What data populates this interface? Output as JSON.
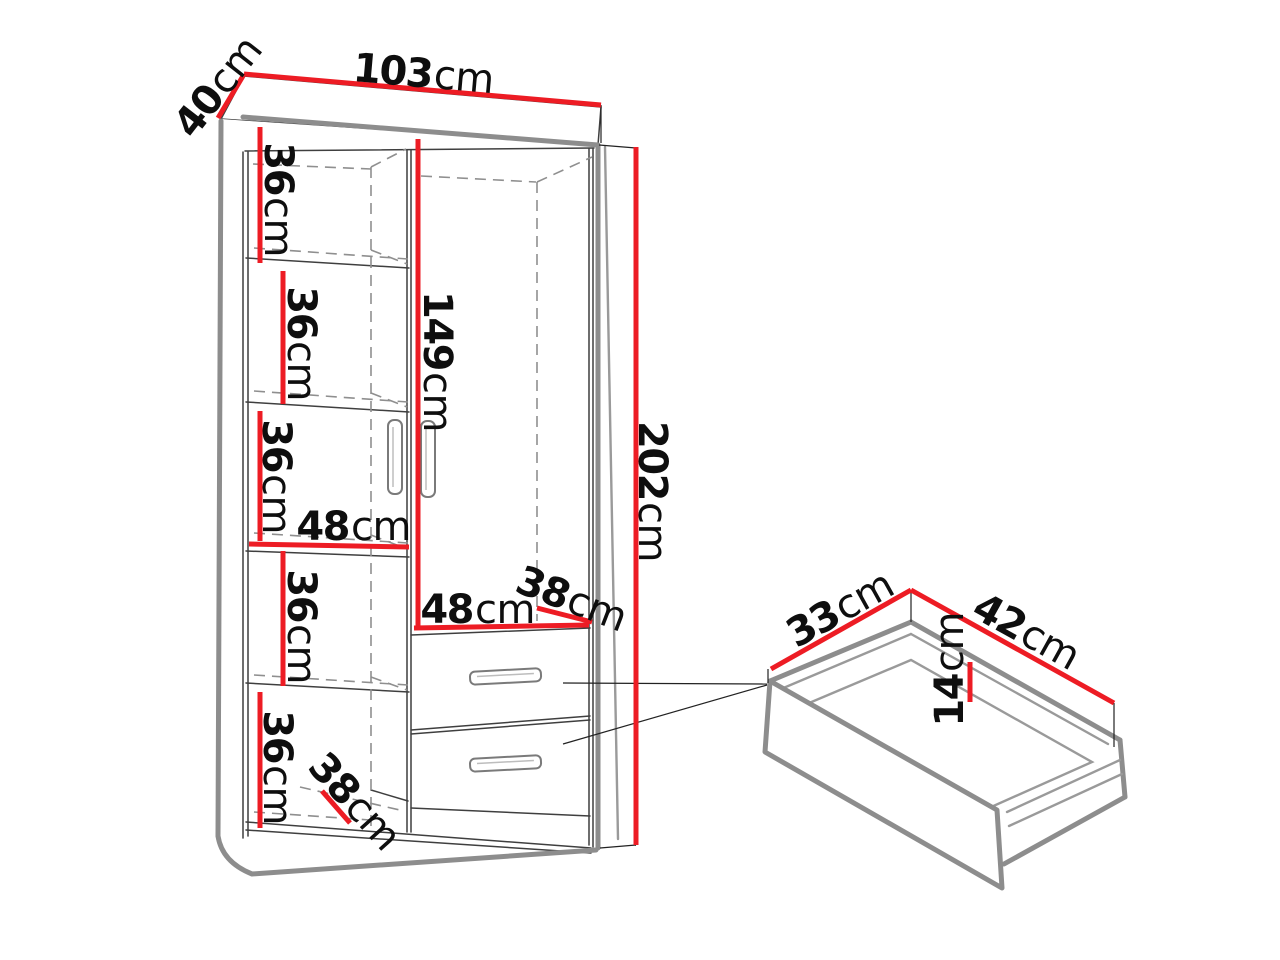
{
  "diagram": {
    "type": "furniture-dimension-diagram",
    "subject": "Two-door wardrobe with five shelf compartments, hanging section and two drawers; detached drawer box detail",
    "unit": "cm",
    "colors": {
      "dimension_line": "#ed1c24",
      "outline": "#8d8d8d",
      "edge_line": "#3f3f3f",
      "hidden_line": "#8f8f8f",
      "text": "#0e0e0e",
      "background": "#ffffff"
    }
  },
  "dims": {
    "width": {
      "value": "103",
      "unit": "cm"
    },
    "depth": {
      "value": "40",
      "unit": "cm"
    },
    "height": {
      "value": "202",
      "unit": "cm"
    },
    "interior_height": {
      "value": "149",
      "unit": "cm"
    },
    "shelf_space_1": {
      "value": "36",
      "unit": "cm"
    },
    "shelf_space_2": {
      "value": "36",
      "unit": "cm"
    },
    "shelf_space_3": {
      "value": "36",
      "unit": "cm"
    },
    "shelf_space_4": {
      "value": "36",
      "unit": "cm"
    },
    "shelf_space_5": {
      "value": "36",
      "unit": "cm"
    },
    "shelf_width": {
      "value": "48",
      "unit": "cm"
    },
    "drawer_front_width": {
      "value": "48",
      "unit": "cm"
    },
    "drawer_front_depth": {
      "value": "38",
      "unit": "cm"
    },
    "bottom_shelf_depth": {
      "value": "38",
      "unit": "cm"
    },
    "drawer_box_depth": {
      "value": "33",
      "unit": "cm"
    },
    "drawer_box_width": {
      "value": "42",
      "unit": "cm"
    },
    "drawer_box_height": {
      "value": "14",
      "unit": "cm"
    }
  }
}
